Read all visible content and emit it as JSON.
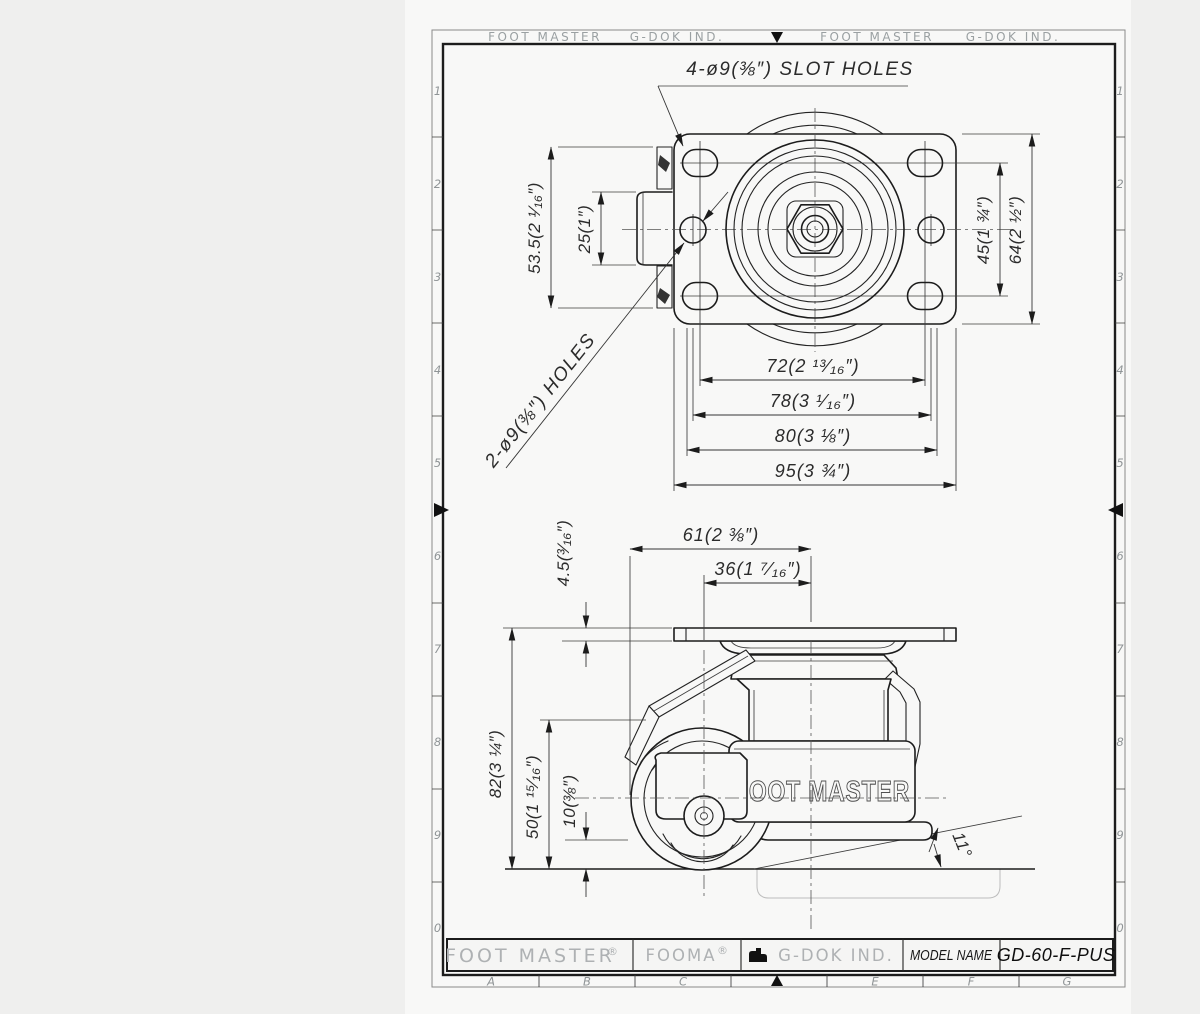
{
  "colors": {
    "background": "#efefee",
    "paper": "#f8f8f7",
    "line": "#1c1c1c",
    "muted_text": "#aeb1b3"
  },
  "frame": {
    "top_labels": [
      "FOOT MASTER",
      "G-DOK IND.",
      "FOOT MASTER",
      "G-DOK IND."
    ],
    "side_numbers": [
      "1",
      "2",
      "3",
      "4",
      "5",
      "6",
      "7",
      "8",
      "9",
      "0"
    ],
    "bottom_letters": [
      "A",
      "B",
      "C",
      "E",
      "F",
      "G"
    ]
  },
  "top_view": {
    "slot_callout": "4-ø9(⅜″) SLOT HOLES",
    "holes_callout": "2-ø9(⅜″) HOLES",
    "dim_53_5": "53.5(2 ¹⁄₁₆″)",
    "dim_25": "25(1″)",
    "dim_45": "45(1 ¾″)",
    "dim_64": "64(2 ½″)",
    "dim_72": "72(2 ¹³⁄₁₆″)",
    "dim_78": "78(3 ¹⁄₁₆″)",
    "dim_80": "80(3 ⅛″)",
    "dim_95": "95(3 ¾″)"
  },
  "side_view": {
    "dim_61": "61(2 ⅜″)",
    "dim_36": "36(1 ⁷⁄₁₆″)",
    "dim_4_5": "4.5(³⁄₁₆″)",
    "dim_82": "82(3 ¼″)",
    "dim_50": "50(1 ¹⁵⁄₁₆″)",
    "dim_10": "10(⅜″)",
    "angle": "11°",
    "emboss": "FOOT MASTER"
  },
  "title_block": {
    "brand": "FOOT MASTER",
    "brand_reg": "®",
    "fooma": "FOOMA",
    "fooma_reg": "®",
    "company": "G-DOK IND.",
    "model_label": "MODEL NAME",
    "model_value": "GD-60-F-PUS"
  }
}
